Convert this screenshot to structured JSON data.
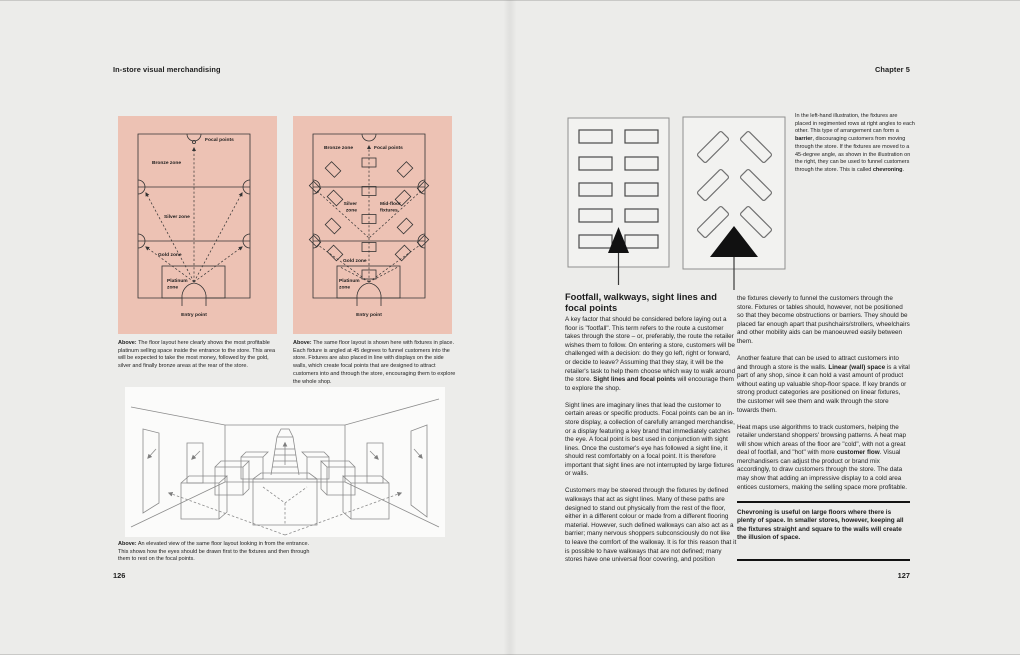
{
  "colors": {
    "page_bg": "#ececea",
    "panel_pink": "#edc2b4",
    "plan_line": "#333333",
    "sketch_line": "#8b8b8b",
    "rule_black": "#121212",
    "diagram_box_bg": "#f2f2f0",
    "diagram_box_border": "#8f8f8f",
    "funnel_arrow": "#111111"
  },
  "left_page": {
    "header": "In-store visual merchandising",
    "page_number": "126",
    "floorplan1": {
      "labels": {
        "focal": "Focal points",
        "bronze": "Bronze zone",
        "silver": "Silver zone",
        "gold": "Gold zone",
        "platinum_line1": "Platinum",
        "platinum_line2": "zone",
        "entry": "Entry point"
      }
    },
    "floorplan2": {
      "labels": {
        "bronze": "Bronze zone",
        "focal": "Focal points",
        "silver_line1": "Silver",
        "silver_line2": "zone",
        "mid_line1": "Mid-floor",
        "mid_line2": "fixtures",
        "gold": "Gold zone",
        "platinum_line1": "Platinum",
        "platinum_line2": "zone",
        "entry": "Entry point"
      }
    },
    "caption1": [
      [
        {
          "t": "Above:",
          "b": true
        },
        {
          "t": " The floor layout here clearly shows the most profitable platinum selling space inside the entrance to the store. This area will be expected to take the most money, followed by the gold, silver and finally bronze areas at the rear of the store."
        }
      ]
    ],
    "caption2": [
      [
        {
          "t": "Above:",
          "b": true
        },
        {
          "t": " The same floor layout is shown here with fixtures in place. Each fixture is angled at 45 degrees to funnel customers into the store. Fixtures are also placed in line with displays on the side walls, which create focal points that are designed to attract customers into and through the store, encouraging them to explore the whole shop."
        }
      ]
    ],
    "illustration_caption": [
      [
        {
          "t": "Above:",
          "b": true
        },
        {
          "t": " An elevated view of the same floor layout looking in from the entrance. This shows how the eyes should be drawn first to the fixtures and then through them to rest on the focal points."
        }
      ]
    ]
  },
  "right_page": {
    "header": "Chapter 5",
    "page_number": "127",
    "diagram_caption": [
      [
        {
          "t": "In the left-hand illustration, the fixtures are placed in regimented rows at right angles to each other. This type of arrangement can form a "
        },
        {
          "t": "barrier",
          "b": true
        },
        {
          "t": ", discouraging customers from moving through the store. If the fixtures are moved to a 45-degree angle, as shown in the illustration on the right, they can be used to funnel customers through the store. This is called "
        },
        {
          "t": "chevroning",
          "b": true
        },
        {
          "t": "."
        }
      ]
    ],
    "section_heading": "Footfall, walkways, sight lines and focal points",
    "col1": [
      [
        {
          "t": "A key factor that should be considered before laying out a floor is \"footfall\". This term refers to the route a customer takes through the store – or, preferably, the route the retailer wishes them to follow. On entering a store, customers will be challenged with a decision: do they go left, right or forward, or decide to leave? Assuming that they stay, it will be the retailer's task to help them choose which way to walk around the store. "
        },
        {
          "t": "Sight lines and focal points",
          "b": true
        },
        {
          "t": " will encourage them to explore the shop."
        }
      ],
      [
        {
          "t": "Sight lines are imaginary lines that lead the customer to certain areas or specific products. Focal points can be an in-store display, a collection of carefully arranged merchandise, or a display featuring a key brand that immediately catches the eye. A focal point is best used in conjunction with sight lines. Once the customer's eye has followed a sight line, it should rest comfortably on a focal point. It is therefore important that sight lines are not interrupted by large fixtures or walls."
        }
      ],
      [
        {
          "t": "Customers may be steered through the fixtures by defined walkways that act as sight lines. Many of these paths are designed to stand out physically from the rest of the floor, either in a different colour or made from a different flooring material. However, such defined walkways can also act as a barrier; many nervous shoppers subconsciously do not like to leave the comfort of the walkway. It is for this reason that it is possible to have walkways that are not defined; many stores have one universal floor covering, and position"
        }
      ]
    ],
    "col2": [
      [
        {
          "t": "the fixtures cleverly to funnel the customers through the store. Fixtures or tables should, however, not be positioned so that they become obstructions or barriers. They should be placed far enough apart that pushchairs/strollers, wheelchairs and other mobility aids can be manoeuvred easily between them."
        }
      ],
      [
        {
          "t": "Another feature that can be used to attract customers into and through a store is the walls. "
        },
        {
          "t": "Linear (wall) space",
          "b": true
        },
        {
          "t": " is a vital part of any shop, since it can hold a vast amount of product without eating up valuable shop-floor space. If key brands or strong product categories are positioned on linear fixtures, the customer will see them and walk through the store towards them."
        }
      ],
      [
        {
          "t": "Heat maps use algorithms to track customers, helping the retailer understand shoppers' browsing patterns. A heat map will show which areas of the floor are \"cold\", with not a great deal of footfall, and \"hot\" with more "
        },
        {
          "t": "customer flow",
          "b": true
        },
        {
          "t": ". Visual merchandisers can adjust the product or brand mix accordingly, to draw customers through the store. The data may show that adding an impressive display to a cold area entices customers, making the selling space more profitable."
        }
      ]
    ],
    "callout": [
      [
        {
          "t": "Chevroning is useful on large floors where there is plenty of space. In smaller stores, however, keeping all the fixtures straight and square to the walls will create the illusion of space.",
          "b": true
        }
      ]
    ]
  }
}
